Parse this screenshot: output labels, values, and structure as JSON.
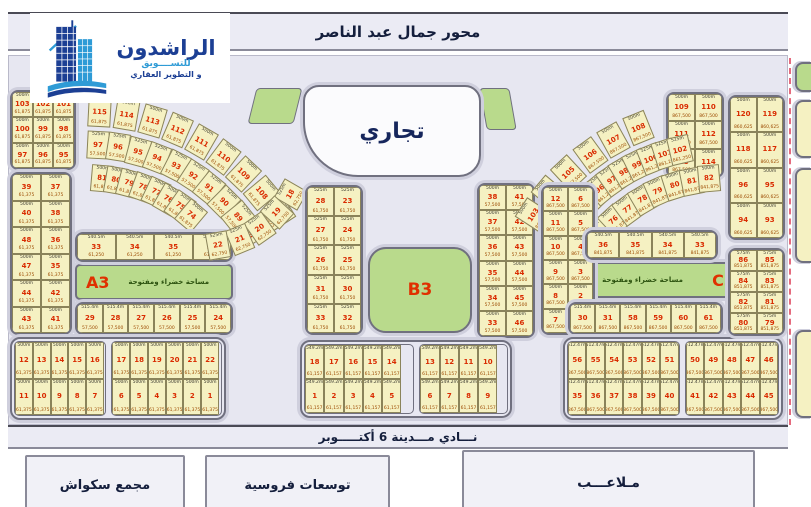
{
  "roads": {
    "axis": "محور جمال عبد الناصر",
    "club": "نـــادي مـــدينة 6 أكتـــــوبر"
  },
  "logo": {
    "name": "الراشدون",
    "tagline1": "للتســــويق",
    "tagline2": "و التطوير العقاري"
  },
  "commercial": {
    "label": "تجاري"
  },
  "zones": {
    "A3": {
      "label": "A3",
      "note": "مساحة خضراء ومفتوحة"
    },
    "B3": {
      "label": "B3"
    },
    "C3": {
      "label": "C3",
      "note": "مساحة خضراء ومفتوحة"
    }
  },
  "facilities": {
    "squash": "مجمع سكواش",
    "equestrian": "توسعات فروسية",
    "courts": "مـلاعـــب"
  },
  "colors": {
    "map_bg": "#e7e7f1",
    "plot_fill": "#f5f1c2",
    "plot_number": "#d92b00",
    "zone_green": "#b9da8c",
    "road_band": "#ebebf4",
    "navy_text": "#141e3c",
    "logo_blue_dark": "#1c3f94",
    "logo_blue_light": "#2e9bd6",
    "boundary_dash": "#e56b7e"
  },
  "plot_clusters": [
    {
      "id": "L1",
      "type": "grid",
      "x": 10,
      "y": 90,
      "w": 66,
      "h": 80,
      "area": "500m",
      "price": "61,875",
      "rows": [
        [
          103,
          102,
          101
        ],
        [
          100,
          99,
          98
        ],
        [
          97,
          96,
          95
        ]
      ]
    },
    {
      "id": "L2-outer",
      "type": "arc",
      "cx": 88,
      "cy": 338,
      "r": 226,
      "a1": -87,
      "a2": -33,
      "cw": 23,
      "ch": 30,
      "area": "500m",
      "price": "61,875",
      "cells": [
        115,
        114,
        113,
        112,
        111,
        110,
        109,
        108,
        107
      ]
    },
    {
      "id": "L2-inner",
      "type": "arc",
      "cx": 88,
      "cy": 338,
      "r": 193,
      "a1": -87,
      "a2": -33,
      "cw": 22,
      "ch": 28,
      "area": "525m",
      "price": "57,500",
      "cells": [
        97,
        96,
        95,
        94,
        93,
        92,
        91,
        90,
        89,
        88
      ]
    },
    {
      "id": "L4-fan",
      "type": "arc",
      "cx": 88,
      "cy": 338,
      "r": 160,
      "a1": -85,
      "a2": -50,
      "cw": 22,
      "ch": 27,
      "area": "500m",
      "price": "61,875",
      "cells": [
        81,
        80,
        79,
        78,
        77,
        76,
        75,
        74
      ]
    },
    {
      "id": "L3-strip",
      "type": "grid",
      "x": 10,
      "y": 172,
      "w": 62,
      "h": 163,
      "area": "500m",
      "price": "61,375",
      "rows": [
        [
          39,
          37
        ],
        [
          40,
          38
        ],
        [
          48,
          36
        ],
        [
          47,
          35
        ],
        [
          44,
          42
        ],
        [
          43,
          41
        ]
      ]
    },
    {
      "id": "L5-row",
      "type": "grid",
      "x": 75,
      "y": 232,
      "w": 158,
      "h": 30,
      "area": "540.5m",
      "price": "61,250",
      "rows": [
        [
          33,
          34,
          35,
          36
        ]
      ]
    },
    {
      "id": "L7-row",
      "type": "grid",
      "x": 75,
      "y": 302,
      "w": 158,
      "h": 33,
      "area": "515.4m",
      "price": "57,500",
      "rows": [
        [
          29,
          28,
          27,
          26,
          25,
          24
        ]
      ]
    },
    {
      "id": "L8-bottom",
      "type": "grid2",
      "x": 10,
      "y": 337,
      "w": 216,
      "h": 83,
      "area": "500m",
      "price": "61,375",
      "blocks": [
        {
          "rows": [
            [
              12,
              13,
              14,
              15,
              16
            ],
            [
              11,
              10,
              9,
              8,
              7
            ]
          ]
        },
        {
          "rows": [
            [
              17,
              18,
              19,
              20,
              21,
              22
            ],
            [
              6,
              5,
              4,
              3,
              2,
              1
            ]
          ]
        }
      ]
    },
    {
      "id": "C-fan",
      "type": "arc",
      "cx": 200,
      "cy": 142,
      "r": 105,
      "a1": 30,
      "a2": 80,
      "cw": 22,
      "ch": 27,
      "rot": -90,
      "area": "525m",
      "price": "62,750",
      "cells": [
        18,
        19,
        20,
        21,
        22
      ]
    },
    {
      "id": "C-left",
      "type": "grid",
      "x": 305,
      "y": 185,
      "w": 58,
      "h": 150,
      "area": "525m",
      "price": "61,750",
      "rows": [
        [
          28,
          23
        ],
        [
          27,
          24
        ],
        [
          26,
          25
        ],
        [
          31,
          30
        ],
        [
          33,
          32
        ]
      ]
    },
    {
      "id": "C-right",
      "type": "grid",
      "x": 477,
      "y": 183,
      "w": 58,
      "h": 155,
      "area": "500m",
      "price": "57,500",
      "rows": [
        [
          38,
          41
        ],
        [
          37,
          42
        ],
        [
          36,
          43
        ],
        [
          35,
          44
        ],
        [
          34,
          45
        ],
        [
          33,
          46
        ]
      ]
    },
    {
      "id": "C-bottom",
      "type": "grid2",
      "x": 300,
      "y": 340,
      "w": 212,
      "h": 78,
      "area": "549.2m",
      "price": "61,157",
      "blocks": [
        {
          "rows": [
            [
              18,
              17,
              16,
              15,
              14
            ],
            [
              1,
              2,
              3,
              4,
              5
            ]
          ]
        },
        {
          "rows": [
            [
              13,
              12,
              11,
              10
            ],
            [
              6,
              7,
              8,
              9
            ]
          ]
        }
      ]
    },
    {
      "id": "R2-corner",
      "type": "grid",
      "x": 666,
      "y": 92,
      "w": 58,
      "h": 86,
      "area": "500m",
      "price": "867,500",
      "rows": [
        [
          109,
          110
        ],
        [
          111,
          112
        ],
        [
          113,
          114
        ]
      ]
    },
    {
      "id": "R1-outer",
      "type": "arc",
      "cx": 723,
      "cy": 338,
      "r": 226,
      "a1": -147,
      "a2": -112,
      "cw": 23,
      "ch": 30,
      "area": "500m",
      "price": "867,500",
      "cells": [
        103,
        104,
        105,
        106,
        107,
        108
      ]
    },
    {
      "id": "R1-inner",
      "type": "arc",
      "cx": 723,
      "cy": 338,
      "r": 193,
      "a1": -143,
      "a2": -103,
      "cw": 22,
      "ch": 28,
      "area": "525m",
      "price": "861,250",
      "cells": [
        93,
        94,
        95,
        96,
        97,
        98,
        99,
        100,
        101,
        102
      ]
    },
    {
      "id": "R4-fan",
      "type": "arc",
      "cx": 723,
      "cy": 338,
      "r": 160,
      "a1": -139,
      "a2": -95,
      "cw": 22,
      "ch": 27,
      "area": "500m",
      "price": "841,875",
      "cells": [
        75,
        76,
        77,
        78,
        79,
        80,
        81,
        82
      ]
    },
    {
      "id": "R-left",
      "type": "grid",
      "x": 541,
      "y": 185,
      "w": 54,
      "h": 150,
      "area": "500m",
      "price": "867,500",
      "rows": [
        [
          12,
          6
        ],
        [
          11,
          5
        ],
        [
          10,
          4
        ],
        [
          9,
          3
        ],
        [
          8,
          2
        ],
        [
          7,
          1
        ]
      ]
    },
    {
      "id": "R5-row",
      "type": "grid",
      "x": 585,
      "y": 230,
      "w": 133,
      "h": 30,
      "area": "540.5m",
      "price": "841,875",
      "rows": [
        [
          36,
          35,
          34,
          33
        ]
      ]
    },
    {
      "id": "R7-row",
      "type": "grid",
      "x": 568,
      "y": 302,
      "w": 155,
      "h": 33,
      "area": "515.4m",
      "price": "867,500",
      "rows": [
        [
          30,
          31,
          58,
          59,
          60,
          61
        ]
      ]
    },
    {
      "id": "R8-bottom",
      "type": "grid2",
      "x": 563,
      "y": 337,
      "w": 220,
      "h": 83,
      "area": "512.47m",
      "price": "867,500",
      "blocks": [
        {
          "rows": [
            [
              56,
              55,
              54,
              53,
              52,
              51
            ],
            [
              35,
              36,
              37,
              38,
              39,
              40
            ]
          ]
        },
        {
          "rows": [
            [
              50,
              49,
              48,
              47,
              46
            ],
            [
              41,
              42,
              43,
              44,
              45
            ]
          ]
        }
      ]
    },
    {
      "id": "R3a-strip",
      "type": "grid",
      "x": 728,
      "y": 95,
      "w": 57,
      "h": 145,
      "area": "500m",
      "price": "860,625",
      "rows": [
        [
          120,
          119
        ],
        [
          118,
          117
        ],
        [
          96,
          95
        ],
        [
          94,
          93
        ]
      ]
    },
    {
      "id": "R3b-strip",
      "type": "grid",
      "x": 728,
      "y": 248,
      "w": 57,
      "h": 88,
      "area": "575m",
      "price": "851,875",
      "rows": [
        [
          86,
          85
        ],
        [
          84,
          83
        ],
        [
          82,
          81
        ],
        [
          80,
          79
        ]
      ]
    }
  ]
}
